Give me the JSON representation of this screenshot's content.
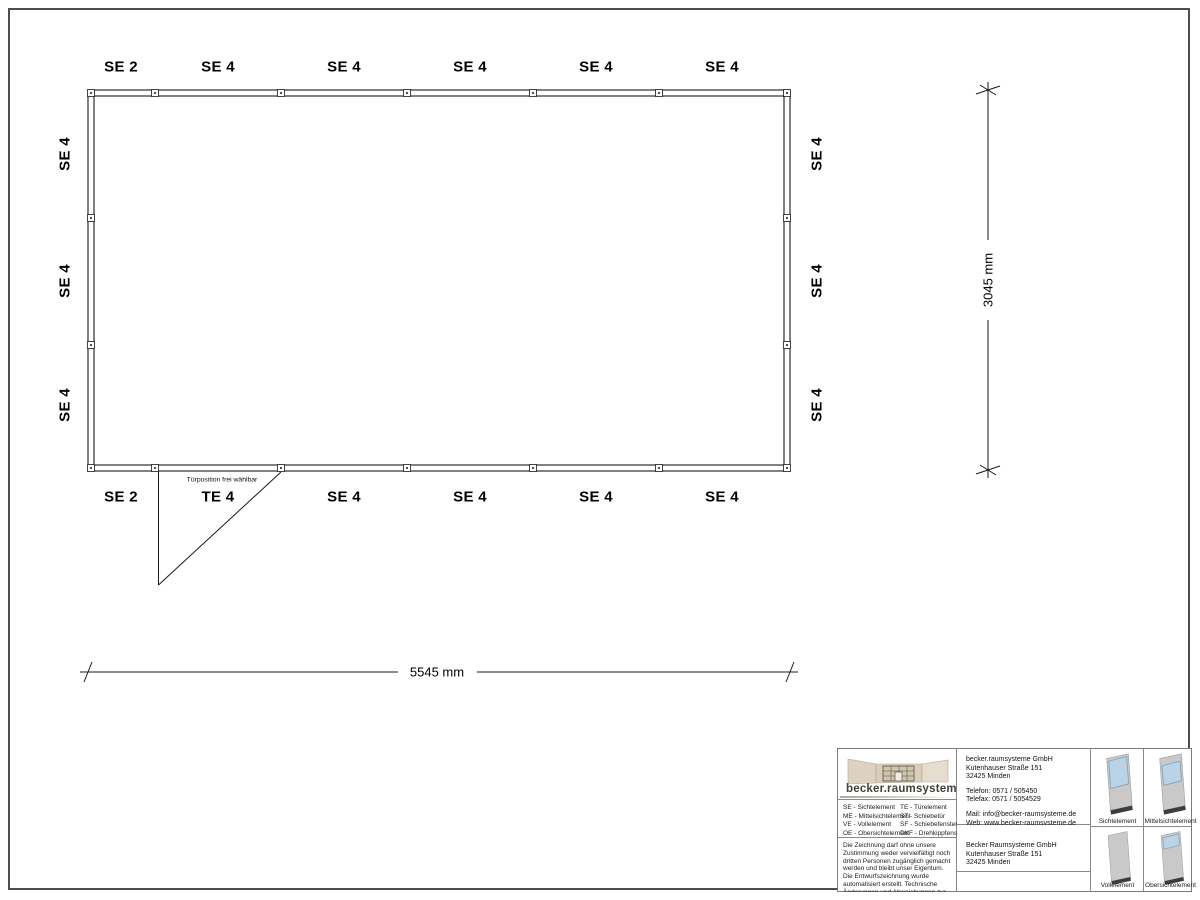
{
  "plan": {
    "top_labels": [
      "SE 2",
      "SE 4",
      "SE 4",
      "SE 4",
      "SE 4",
      "SE 4"
    ],
    "bottom_labels": [
      "SE 2",
      "TE 4",
      "SE 4",
      "SE 4",
      "SE 4",
      "SE 4"
    ],
    "left_labels": [
      "SE 4",
      "SE 4",
      "SE 4"
    ],
    "right_labels": [
      "SE 4",
      "SE 4",
      "SE 4"
    ],
    "door_note": "Türposition frei wählbar",
    "width_dim": "5545 mm",
    "height_dim": "3045 mm"
  },
  "title_block": {
    "logo_text": "becker.raumsysteme®",
    "legend": {
      "col1": [
        "SE - Sichtelement",
        "ME - Mittelsichtelement",
        "VE - Vollelement",
        "OE - Obersichtelement"
      ],
      "col2": [
        "TE - Türelement",
        "ST - Schiebetür",
        "SF - Schiebefenster",
        "DKF - Drehkippfenster"
      ]
    },
    "disclaimer": "Die Zeichnung darf ohne unsere Zustimmung weder vervielfältigt noch dritten Personen zugänglich gemacht werden und bleibt unser Eigentum. Die Entwurfszeichnung wurde automatisiert erstellt. Technische Änderungen und Abweichungen zur Ausführungszeichnung behalten wir uns vor.",
    "contact": {
      "company": "becker.raumsysteme GmbH",
      "street": "Kutenhauser Straße 151",
      "city": "32425 Minden",
      "phone": "Telefon: 0571 / 505450",
      "fax": "Telefax: 0571 / 5054529",
      "mail": "Mail: info@becker-raumsysteme.de",
      "web": "Web: www.becker-raumsysteme.de"
    },
    "customer": {
      "company": "Becker Raumsysteme GmbH",
      "street": "Kutenhauser Straße 151",
      "city": "32425 Minden"
    },
    "elements": [
      {
        "name": "Sichtelement"
      },
      {
        "name": "Mittelsichtelement"
      },
      {
        "name": "Vollelement"
      },
      {
        "name": "Obersichtelement"
      }
    ]
  },
  "colors": {
    "line": "#1a1a1a",
    "frame": "#4d4d4d",
    "table_border": "#8a8a8a",
    "glass": "#bad3e6",
    "glass_border": "#7e9cb4",
    "panel": "#c9c9c9",
    "panel_base": "#3d3d3d",
    "logo_beige": "#d9cdbb",
    "logo_text": "#46413a"
  }
}
